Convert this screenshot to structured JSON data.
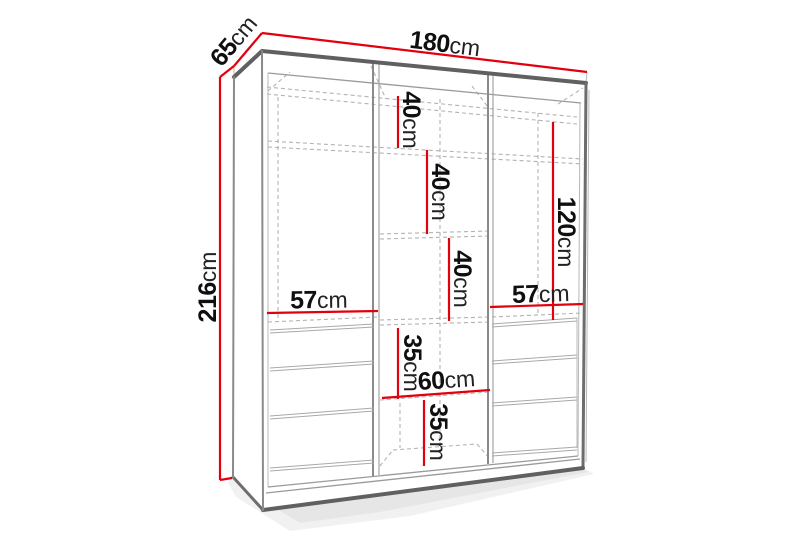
{
  "diagram": {
    "type": "furniture-dimension-drawing",
    "subject": "wardrobe",
    "colors": {
      "background": "#ffffff",
      "dimension_line_red": "#e2000e",
      "edge_gray": "#606060",
      "dashed_gray": "#b3b3b3",
      "label_text": "#0f0f0f"
    },
    "dimensions": {
      "height": {
        "value": "216",
        "unit": "cm"
      },
      "depth": {
        "value": "65",
        "unit": "cm"
      },
      "width": {
        "value": "180",
        "unit": "cm"
      },
      "shelf_gap_top": {
        "value": "40",
        "unit": "cm"
      },
      "shelf_gap_middle": {
        "value": "40",
        "unit": "cm"
      },
      "shelf_gap_lower": {
        "value": "40",
        "unit": "cm"
      },
      "hanging_height_right": {
        "value": "120",
        "unit": "cm"
      },
      "left_section_width": {
        "value": "57",
        "unit": "cm"
      },
      "right_section_width": {
        "value": "57",
        "unit": "cm"
      },
      "drawer_gap_upper": {
        "value": "35",
        "unit": "cm"
      },
      "middle_section_width": {
        "value": "60",
        "unit": "cm"
      },
      "drawer_gap_lower": {
        "value": "35",
        "unit": "cm"
      }
    }
  }
}
